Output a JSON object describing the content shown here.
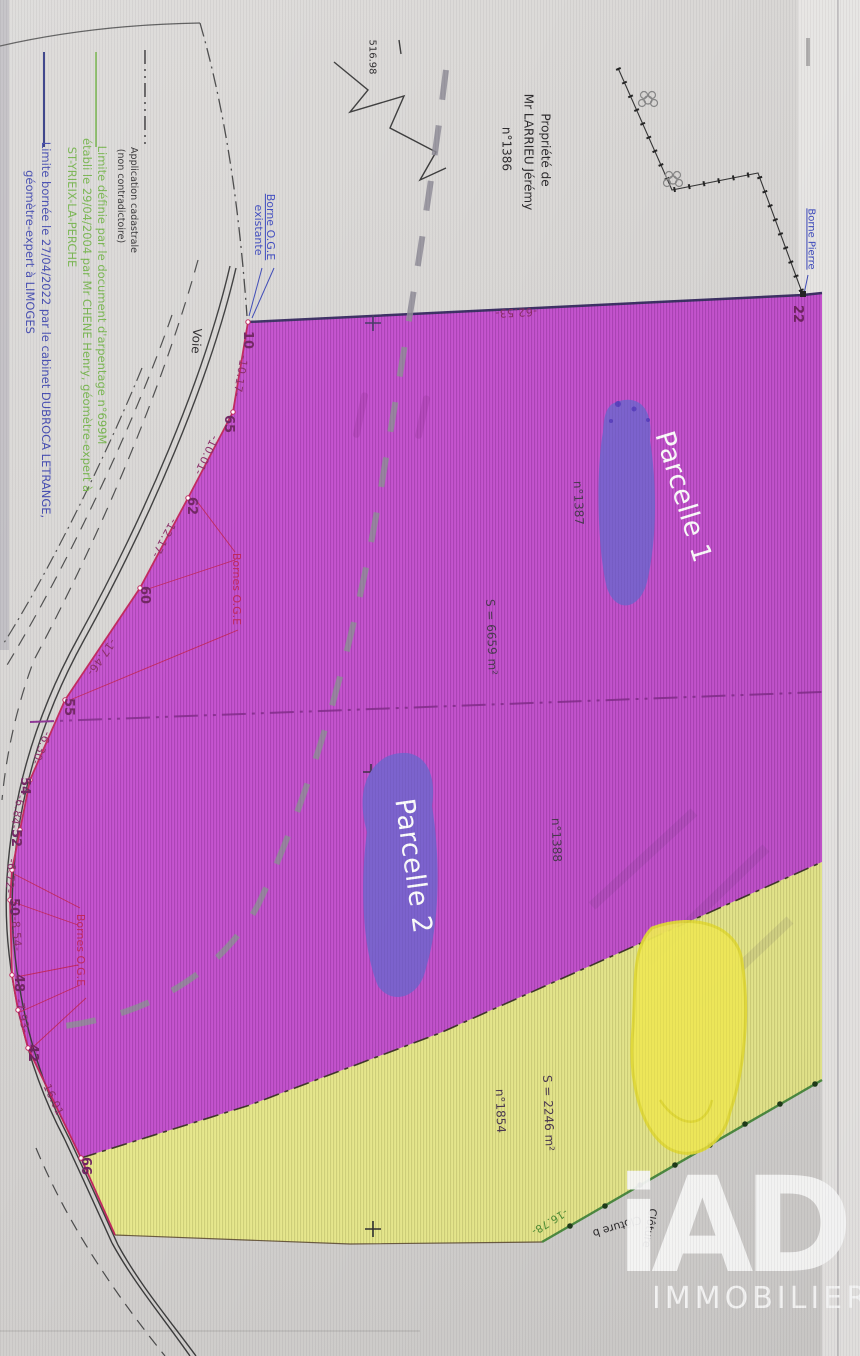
{
  "colors": {
    "parcel_magenta": "#c551cf",
    "parcel_yellow": "#e9ea8d",
    "scribble_purple": "#7b61cf",
    "scribble_yellow": "#f6ef57",
    "boundary_red": "#c2255c",
    "division_magenta": "#8b2f93",
    "legend_green": "#74b44a",
    "legend_blue": "#3c44ae",
    "page_gray": "#d8d6d4"
  },
  "legend": {
    "items": [
      {
        "symbol": "black-dash-dot-line",
        "text": "Application cadastrale (non contradictoire)"
      },
      {
        "symbol": "green-solid-line",
        "text": "Limite définie par le document d'arpentage n°699M établi le 29/04/2004 par Mr CHENE Henry, géomètre-expert à ST-YRIEIX-LA-PERCHE"
      },
      {
        "symbol": "blue-solid-line",
        "text": "Limite bornée le 27/04/2022 par le cabinet DUBROCA LETRANGE, géomètre-expert à LIMOGES"
      }
    ]
  },
  "parcels": {
    "parcel1": {
      "label": "Parcelle 1",
      "number": "n°1387",
      "area": "S = 6659 m²"
    },
    "parcel2": {
      "label": "Parcelle 2",
      "number": "n°1388"
    },
    "parcel3": {
      "number": "n°1854",
      "area": "S = 2246 m²"
    }
  },
  "owner_block": [
    "Propriété de",
    "Mr LARRIEU Jérémy",
    "n°1386"
  ],
  "logo": {
    "brand": "iAD",
    "tagline": "IMMOBILIER"
  },
  "annotations": [
    {
      "name": "legend-cadastrale-line1",
      "text": "Application cadastrale",
      "x": 133,
      "y": 200,
      "rot": 90,
      "cls": "leg-black"
    },
    {
      "name": "legend-cadastrale-line2",
      "text": "(non contradictoire)",
      "x": 120,
      "y": 196,
      "rot": 90,
      "cls": "leg-black"
    },
    {
      "name": "legend-arpentage-line1",
      "text": "Limite définie par le document d'arpentage n°699M",
      "x": 102,
      "y": 295,
      "rot": 90,
      "cls": "leg-green"
    },
    {
      "name": "legend-arpentage-line2",
      "text": "établi le 29/04/2004 par Mr CHENE Henry, géomètre-expert à",
      "x": 87,
      "y": 315,
      "rot": 90,
      "cls": "leg-green"
    },
    {
      "name": "legend-arpentage-line3",
      "text": "ST-YRIEIX-LA-PERCHE",
      "x": 72,
      "y": 207,
      "rot": 90,
      "cls": "leg-green"
    },
    {
      "name": "legend-bornee-line1",
      "text": "Limite bornée le 27/04/2022 par le cabinet DUBROCA LETRANGE,",
      "x": 46,
      "y": 330,
      "rot": 90,
      "cls": "leg-blue"
    },
    {
      "name": "legend-bornee-line2",
      "text": "géomètre-expert à LIMOGES",
      "x": 30,
      "y": 252,
      "rot": 90,
      "cls": "leg-blue"
    },
    {
      "name": "label-borne-oge-existante-line1",
      "text": "Borne O.G.E",
      "x": 270,
      "y": 227,
      "rot": 90,
      "cls": "blue u s11"
    },
    {
      "name": "label-borne-oge-existante-line2",
      "text": "existante",
      "x": 258,
      "y": 230,
      "rot": 90,
      "cls": "blue s11"
    },
    {
      "name": "label-voie",
      "text": "Voie",
      "x": 196,
      "y": 341,
      "rot": 94,
      "cls": "black s12"
    },
    {
      "name": "label-516-98",
      "text": "516.98",
      "x": 371,
      "y": 57,
      "rot": 90,
      "cls": "black s10"
    },
    {
      "name": "owner-line1",
      "text": "Propriété de",
      "x": 545,
      "y": 150,
      "rot": 90,
      "cls": "black s12"
    },
    {
      "name": "owner-line2",
      "text": "Mr LARRIEU Jérémy",
      "x": 528,
      "y": 152,
      "rot": 90,
      "cls": "black s12"
    },
    {
      "name": "owner-line3",
      "text": "n°1386",
      "x": 506,
      "y": 149,
      "rot": 90,
      "cls": "black s12"
    },
    {
      "name": "label-borne-pierre",
      "text": "Borne Pierre",
      "x": 810,
      "y": 239,
      "rot": 90,
      "cls": "blue u s10"
    },
    {
      "name": "vertex-22",
      "text": "22",
      "x": 797,
      "y": 314,
      "rot": 90,
      "cls": "vtx"
    },
    {
      "name": "dist-62-53",
      "text": "-62.53-",
      "x": 516,
      "y": 312,
      "rot": 177,
      "cls": "dist"
    },
    {
      "name": "vertex-10",
      "text": "10",
      "x": 247,
      "y": 340,
      "rot": 90,
      "cls": "vtx"
    },
    {
      "name": "dist-10-17",
      "text": "-10.17-",
      "x": 240,
      "y": 376,
      "rot": 100,
      "cls": "dist"
    },
    {
      "name": "vertex-65",
      "text": "65",
      "x": 228,
      "y": 424,
      "rot": 90,
      "cls": "vtx"
    },
    {
      "name": "dist-10-01",
      "text": "-10.01-",
      "x": 206,
      "y": 455,
      "rot": 115,
      "cls": "dist"
    },
    {
      "name": "vertex-62",
      "text": "62",
      "x": 191,
      "y": 506,
      "rot": 90,
      "cls": "vtx"
    },
    {
      "name": "dist-12-17",
      "text": "-12.17-",
      "x": 164,
      "y": 538,
      "rot": 118,
      "cls": "dist"
    },
    {
      "name": "vertex-60",
      "text": "60",
      "x": 144,
      "y": 595,
      "rot": 90,
      "cls": "vtx"
    },
    {
      "name": "dist-17-46",
      "text": "-17.46-",
      "x": 101,
      "y": 657,
      "rot": 125,
      "cls": "dist"
    },
    {
      "name": "vertex-55",
      "text": "55",
      "x": 68,
      "y": 707,
      "rot": 90,
      "cls": "vtx"
    },
    {
      "name": "dist-6-30",
      "text": "-6.30-",
      "x": 41,
      "y": 748,
      "rot": 112,
      "cls": "dist"
    },
    {
      "name": "vertex-54",
      "text": "54",
      "x": 24,
      "y": 786,
      "rot": 90,
      "cls": "vtx"
    },
    {
      "name": "dist-6-84",
      "text": "-6.84-",
      "x": 17,
      "y": 812,
      "rot": 101,
      "cls": "dist"
    },
    {
      "name": "vertex-52",
      "text": "52",
      "x": 15,
      "y": 838,
      "rot": 90,
      "cls": "vtx"
    },
    {
      "name": "dist-6-72",
      "text": "-6.72-",
      "x": 10,
      "y": 876,
      "rot": 95,
      "cls": "dist"
    },
    {
      "name": "vertex-50",
      "text": "50",
      "x": 13,
      "y": 907,
      "rot": 90,
      "cls": "vtx"
    },
    {
      "name": "dist-8-54",
      "text": "-8.54-",
      "x": 16,
      "y": 934,
      "rot": 86,
      "cls": "dist"
    },
    {
      "name": "vertex-48",
      "text": "48",
      "x": 18,
      "y": 983,
      "rot": 90,
      "cls": "vtx"
    },
    {
      "name": "dist-7-93",
      "text": "-7.93-",
      "x": 22,
      "y": 1016,
      "rot": 79,
      "cls": "dist"
    },
    {
      "name": "vertex-42",
      "text": "42",
      "x": 32,
      "y": 1053,
      "rot": 90,
      "cls": "vtx"
    },
    {
      "name": "dist-16-01",
      "text": "-16.01-",
      "x": 53,
      "y": 1100,
      "rot": 65,
      "cls": "dist"
    },
    {
      "name": "vertex-66",
      "text": "66",
      "x": 85,
      "y": 1166,
      "rot": 90,
      "cls": "vtx"
    },
    {
      "name": "label-bornes-oge-1",
      "text": "Bornes O.G.E",
      "x": 236,
      "y": 589,
      "rot": 90,
      "cls": "red s11"
    },
    {
      "name": "label-bornes-oge-2",
      "text": "Bornes O.G.E",
      "x": 80,
      "y": 950,
      "rot": 90,
      "cls": "red s11"
    },
    {
      "name": "parcel1-number",
      "text": "n°1387",
      "x": 578,
      "y": 503,
      "rot": 88,
      "cls": "dark s12"
    },
    {
      "name": "parcel1-area",
      "text": "S = 6659 m²",
      "x": 491,
      "y": 637,
      "rot": 88,
      "cls": "dark s12"
    },
    {
      "name": "parcel1-label",
      "text": "Parcelle 1",
      "x": 683,
      "y": 497,
      "rot": 73,
      "cls": "white-big"
    },
    {
      "name": "parcel2-number",
      "text": "n°1388",
      "x": 556,
      "y": 840,
      "rot": 88,
      "cls": "dark s12"
    },
    {
      "name": "parcel2-label",
      "text": "Parcelle 2",
      "x": 413,
      "y": 866,
      "rot": 82,
      "cls": "white-big"
    },
    {
      "name": "parcel3-number",
      "text": "n°1854",
      "x": 500,
      "y": 1111,
      "rot": 88,
      "cls": "dark s12"
    },
    {
      "name": "parcel3-area",
      "text": "S = 2246 m²",
      "x": 548,
      "y": 1113,
      "rot": 88,
      "cls": "dark s12"
    },
    {
      "name": "dist-16-78",
      "text": "-16.78-",
      "x": 549,
      "y": 1221,
      "rot": 148,
      "cls": "green-dist"
    },
    {
      "name": "label-cloture-b",
      "text": "Clôture b",
      "x": 617,
      "y": 1226,
      "rot": 163,
      "cls": "black s11"
    },
    {
      "name": "label-cloture-2",
      "text": "Clôture",
      "x": 649,
      "y": 1228,
      "rot": 100,
      "cls": "black s11"
    }
  ]
}
